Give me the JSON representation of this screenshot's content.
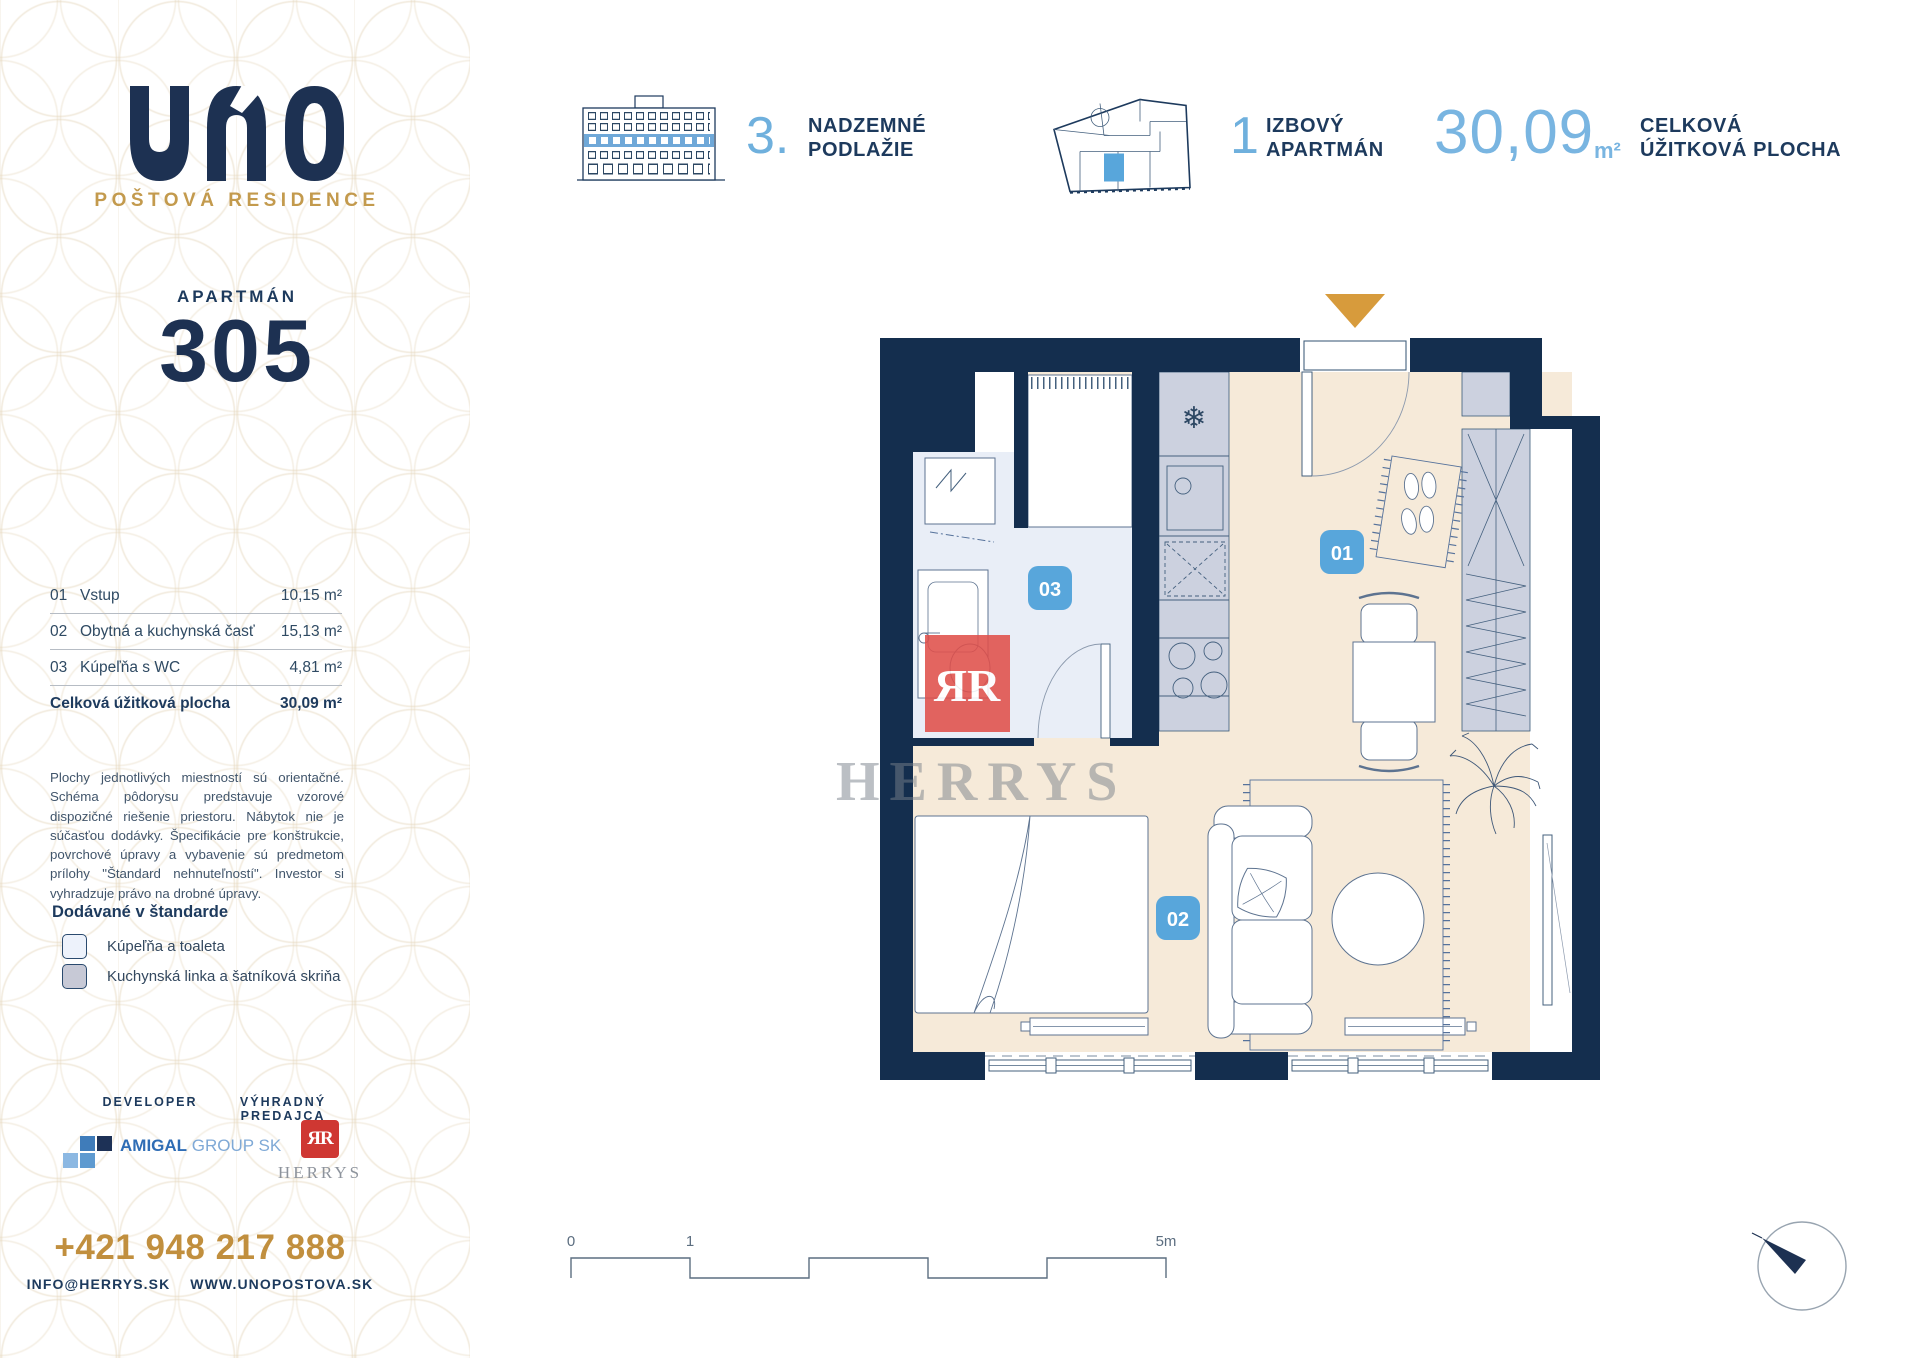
{
  "brand": {
    "name": "UNO",
    "subtitle": "POŠTOVÁ RESIDENCE"
  },
  "apartment": {
    "label": "APARTMÁN",
    "number": "305"
  },
  "header": {
    "floor": {
      "number": "3.",
      "line1": "NADZEMNÉ",
      "line2": "PODLAŽIE"
    },
    "unit": {
      "number": "1",
      "line1": "IZBOVÝ",
      "line2": "APARTMÁN"
    },
    "area": {
      "value": "30,09",
      "unit": "m²",
      "line1": "CELKOVÁ",
      "line2": "ÚŽITKOVÁ PLOCHA"
    }
  },
  "rooms": {
    "rows": [
      {
        "code": "01",
        "name": "Vstup",
        "area": "10,15 m²"
      },
      {
        "code": "02",
        "name": "Obytná a kuchynská časť",
        "area": "15,13 m²"
      },
      {
        "code": "03",
        "name": "Kúpeľňa s WC",
        "area": "4,81 m²"
      }
    ],
    "total": {
      "label": "Celková úžitková plocha",
      "area": "30,09 m²"
    }
  },
  "disclaimer": "Plochy jednotlivých miestností sú orientačné. Schéma pôdorysu predstavuje vzorové dispozičné riešenie priestoru. Nábytok nie je súčasťou dodávky. Špecifikácie pre konštrukcie, povrchové úpravy a vybavenie sú predmetom prílohy \"Štandard nehnuteľností\". Investor si vyhradzuje právo na drobné úpravy.",
  "legend": {
    "title": "Dodávané v štandarde",
    "items": [
      {
        "label": "Kúpeľňa a toaleta",
        "color": "#edf2fb"
      },
      {
        "label": "Kuchynská linka a šatníková skriňa",
        "color": "#c7c9d6"
      }
    ]
  },
  "partners": {
    "developer_label": "DEVELOPER",
    "developer_brand": "AMIGAL",
    "developer_brand_suffix": " GROUP SK",
    "seller_label": "VÝHRADNÝ PREDAJCA",
    "seller_mark": "ЯR",
    "seller_name": "HERRYS"
  },
  "contact": {
    "phone": "+421 948 217 888",
    "email": "INFO@HERRYS.SK",
    "website": "WWW.UNOPOSTOVA.SK"
  },
  "plan": {
    "badge_entry": "01",
    "badge_living": "02",
    "badge_bathroom": "03",
    "watermark_text": "HERRYS",
    "watermark_mark": "ЯR",
    "scale": {
      "zero": "0",
      "one": "1",
      "end": "5m"
    },
    "icons": {
      "snowflake": "❄"
    }
  },
  "colors": {
    "navy": "#1d3152",
    "wall_navy": "#142e4e",
    "light_blue": "#6fb0dd",
    "badge_blue": "#58a6db",
    "gold": "#c39a4d",
    "arrow_gold": "#d79b3c",
    "floor_beige": "#f6ead9",
    "bathroom_blue": "#e9eef7",
    "cabinet_gray": "#ccd1df",
    "herrys_red": "#cf3732"
  }
}
